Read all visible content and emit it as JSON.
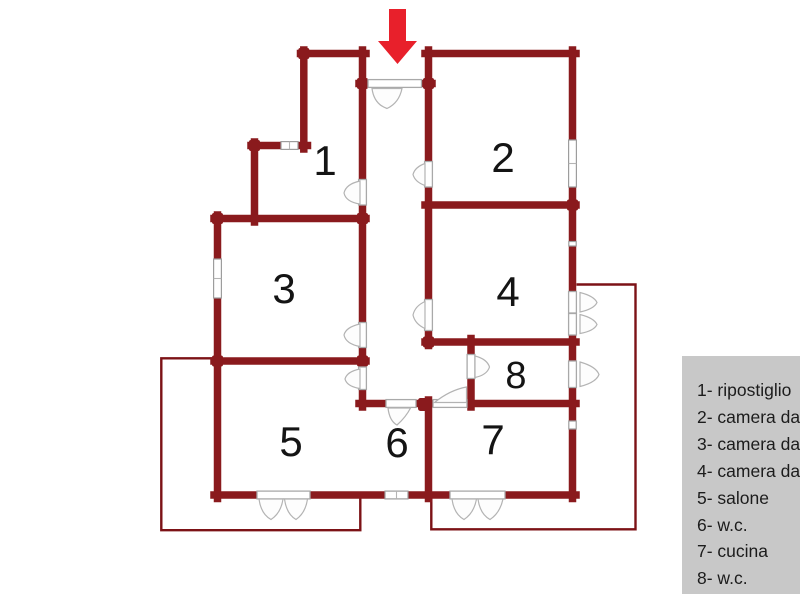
{
  "colors": {
    "wall": "#8a1a1d",
    "balcony_outline": "#7c1216",
    "arrow": "#e8202b",
    "legend_background": "#c8c8c8",
    "legend_text": "#1c1c1c"
  },
  "rooms": [
    {
      "number": "1",
      "name": "ripostiglio"
    },
    {
      "number": "2",
      "name": "camera da letto"
    },
    {
      "number": "3",
      "name": "camera da letto"
    },
    {
      "number": "4",
      "name": "camera da letto"
    },
    {
      "number": "5",
      "name": "salone"
    },
    {
      "number": "6",
      "name": "w.c."
    },
    {
      "number": "7",
      "name": "cucina"
    },
    {
      "number": "8",
      "name": "w.c."
    }
  ],
  "legend": {
    "items": [
      "1- ripostiglio",
      "2- camera da letto",
      "3- camera da letto",
      "4- camera da letto",
      "5- salone",
      "6- w.c.",
      "7- cucina",
      "8- w.c."
    ]
  }
}
